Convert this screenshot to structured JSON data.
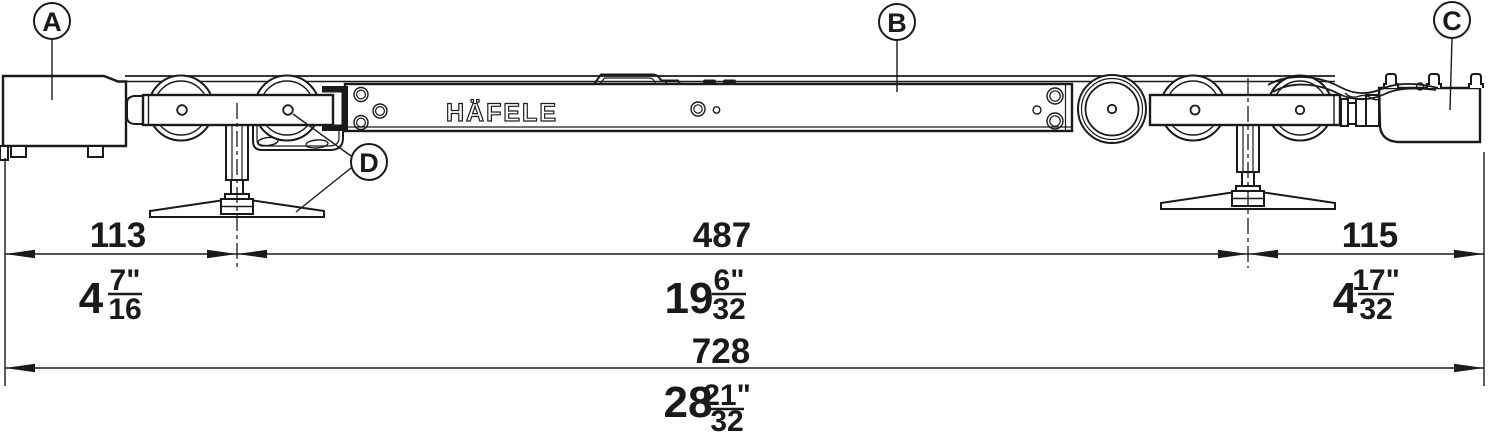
{
  "diagram": {
    "brand_label": "HÄFELE",
    "callouts": {
      "a": "A",
      "b": "B",
      "c": "C",
      "d": "D"
    },
    "dims": {
      "left": {
        "mm": "113",
        "in_whole": "4",
        "in_num": "7\"",
        "in_den": "16"
      },
      "center": {
        "mm": "487",
        "in_whole": "19",
        "in_num": "6\"",
        "in_den": "32"
      },
      "right": {
        "mm": "115",
        "in_whole": "4",
        "in_num": "17\"",
        "in_den": "32"
      },
      "overall": {
        "mm": "728",
        "in_whole": "28",
        "in_num": "21\"",
        "in_den": "32"
      }
    }
  }
}
